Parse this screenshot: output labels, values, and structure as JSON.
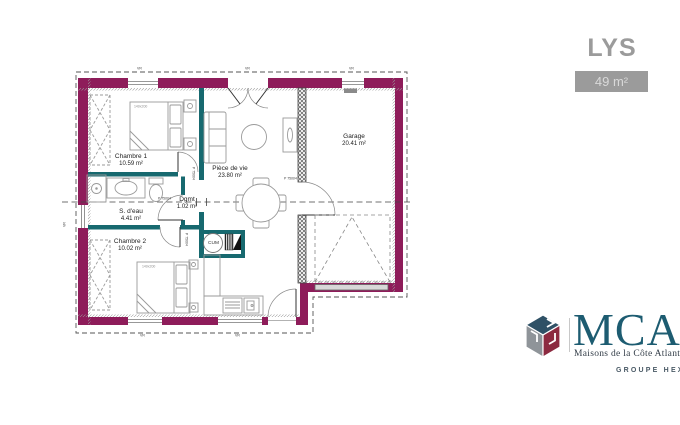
{
  "header": {
    "model_name": "LYS",
    "area_badge": "49 m²"
  },
  "plan": {
    "rooms": [
      {
        "name": "Chambre 1",
        "area": "10.59 m²"
      },
      {
        "name": "S. d'eau",
        "area": "4.41 m²"
      },
      {
        "name": "Chambre 2",
        "area": "10.02 m²"
      },
      {
        "name": "Dgmt",
        "area": "1.02 m²"
      },
      {
        "name": "Pièce de vie",
        "area": "23.80 m²"
      },
      {
        "name": "Garage",
        "area": "20.41 m²"
      }
    ],
    "labels": {
      "water_heater": "CUM",
      "door_ref": "P 75004",
      "bed_size": "140x200",
      "window_marker": "VR"
    }
  },
  "logo": {
    "brand": "MCA",
    "tagline": "Maisons de la Côte Atlantique",
    "group": "GROUPE HEXAOM"
  },
  "colors": {
    "exterior_wall": "#8e1c5a",
    "interior_partition": "#17696f",
    "header_gray": "#9b9b9b",
    "logo_teal": "#1d5c71",
    "logo_red": "#8c2a40",
    "logo_gray": "#8f9499"
  }
}
